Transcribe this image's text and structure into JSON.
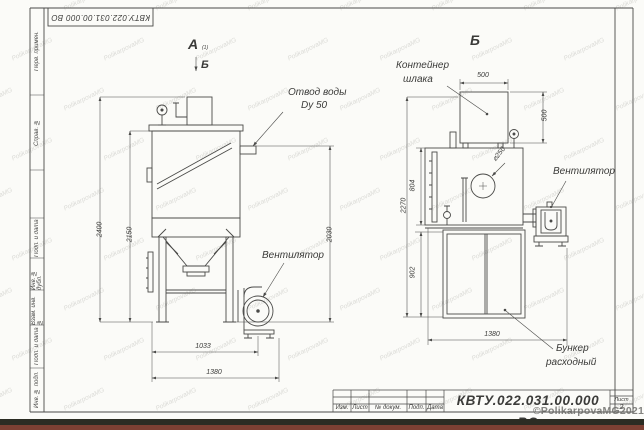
{
  "frame": {
    "doc_number_top": "КВТУ.022.031.00.000  ВО",
    "left_column_labels": [
      "Перв. примен.",
      "Справ. №",
      "Подп. и дата",
      "Инв. № дубл.",
      "Взам. инв. №",
      "Подп. и дата",
      "Инв. № подл."
    ]
  },
  "title_block": {
    "doc_number": "КВТУ.022.031.00.000  ВО",
    "bottom_row_labels": [
      "Изм.",
      "Лист",
      "№ докум.",
      "Подп.",
      "Дата"
    ],
    "sheet_label": "Лист",
    "sheet_number": "2"
  },
  "views": {
    "left": {
      "label": "А",
      "label_sub": "(1)",
      "section_mark": "Б",
      "callouts": {
        "water_outlet_line1": "Отвод воды",
        "water_outlet_line2": "Dy 50",
        "fan": "Вентилятор"
      },
      "dims": {
        "height_total": "2400",
        "height_body": "2150",
        "height_right": "2030",
        "width_inner": "1033",
        "width_total": "1380"
      }
    },
    "right": {
      "label": "Б",
      "callouts": {
        "slag_container_line1": "Контейнер",
        "slag_container_line2": "шлака",
        "fan": "Вентилятор",
        "bunker_line1": "Бункер",
        "bunker_line2": "расходный",
        "diameter": "⌀250"
      },
      "dims": {
        "container_width": "500",
        "container_height": "500",
        "body_height": "804",
        "height_total": "2270",
        "bunker_height": "902",
        "width_total": "1380"
      }
    }
  },
  "watermark": {
    "tile_text": "PolikarpovaMG",
    "copyright": "©PolikarpovaMG2021"
  },
  "colors": {
    "line": "#4a4a48",
    "background": "#fbfbf8",
    "strip_dark": "#2b2c23",
    "strip_red": "#7c4033"
  }
}
